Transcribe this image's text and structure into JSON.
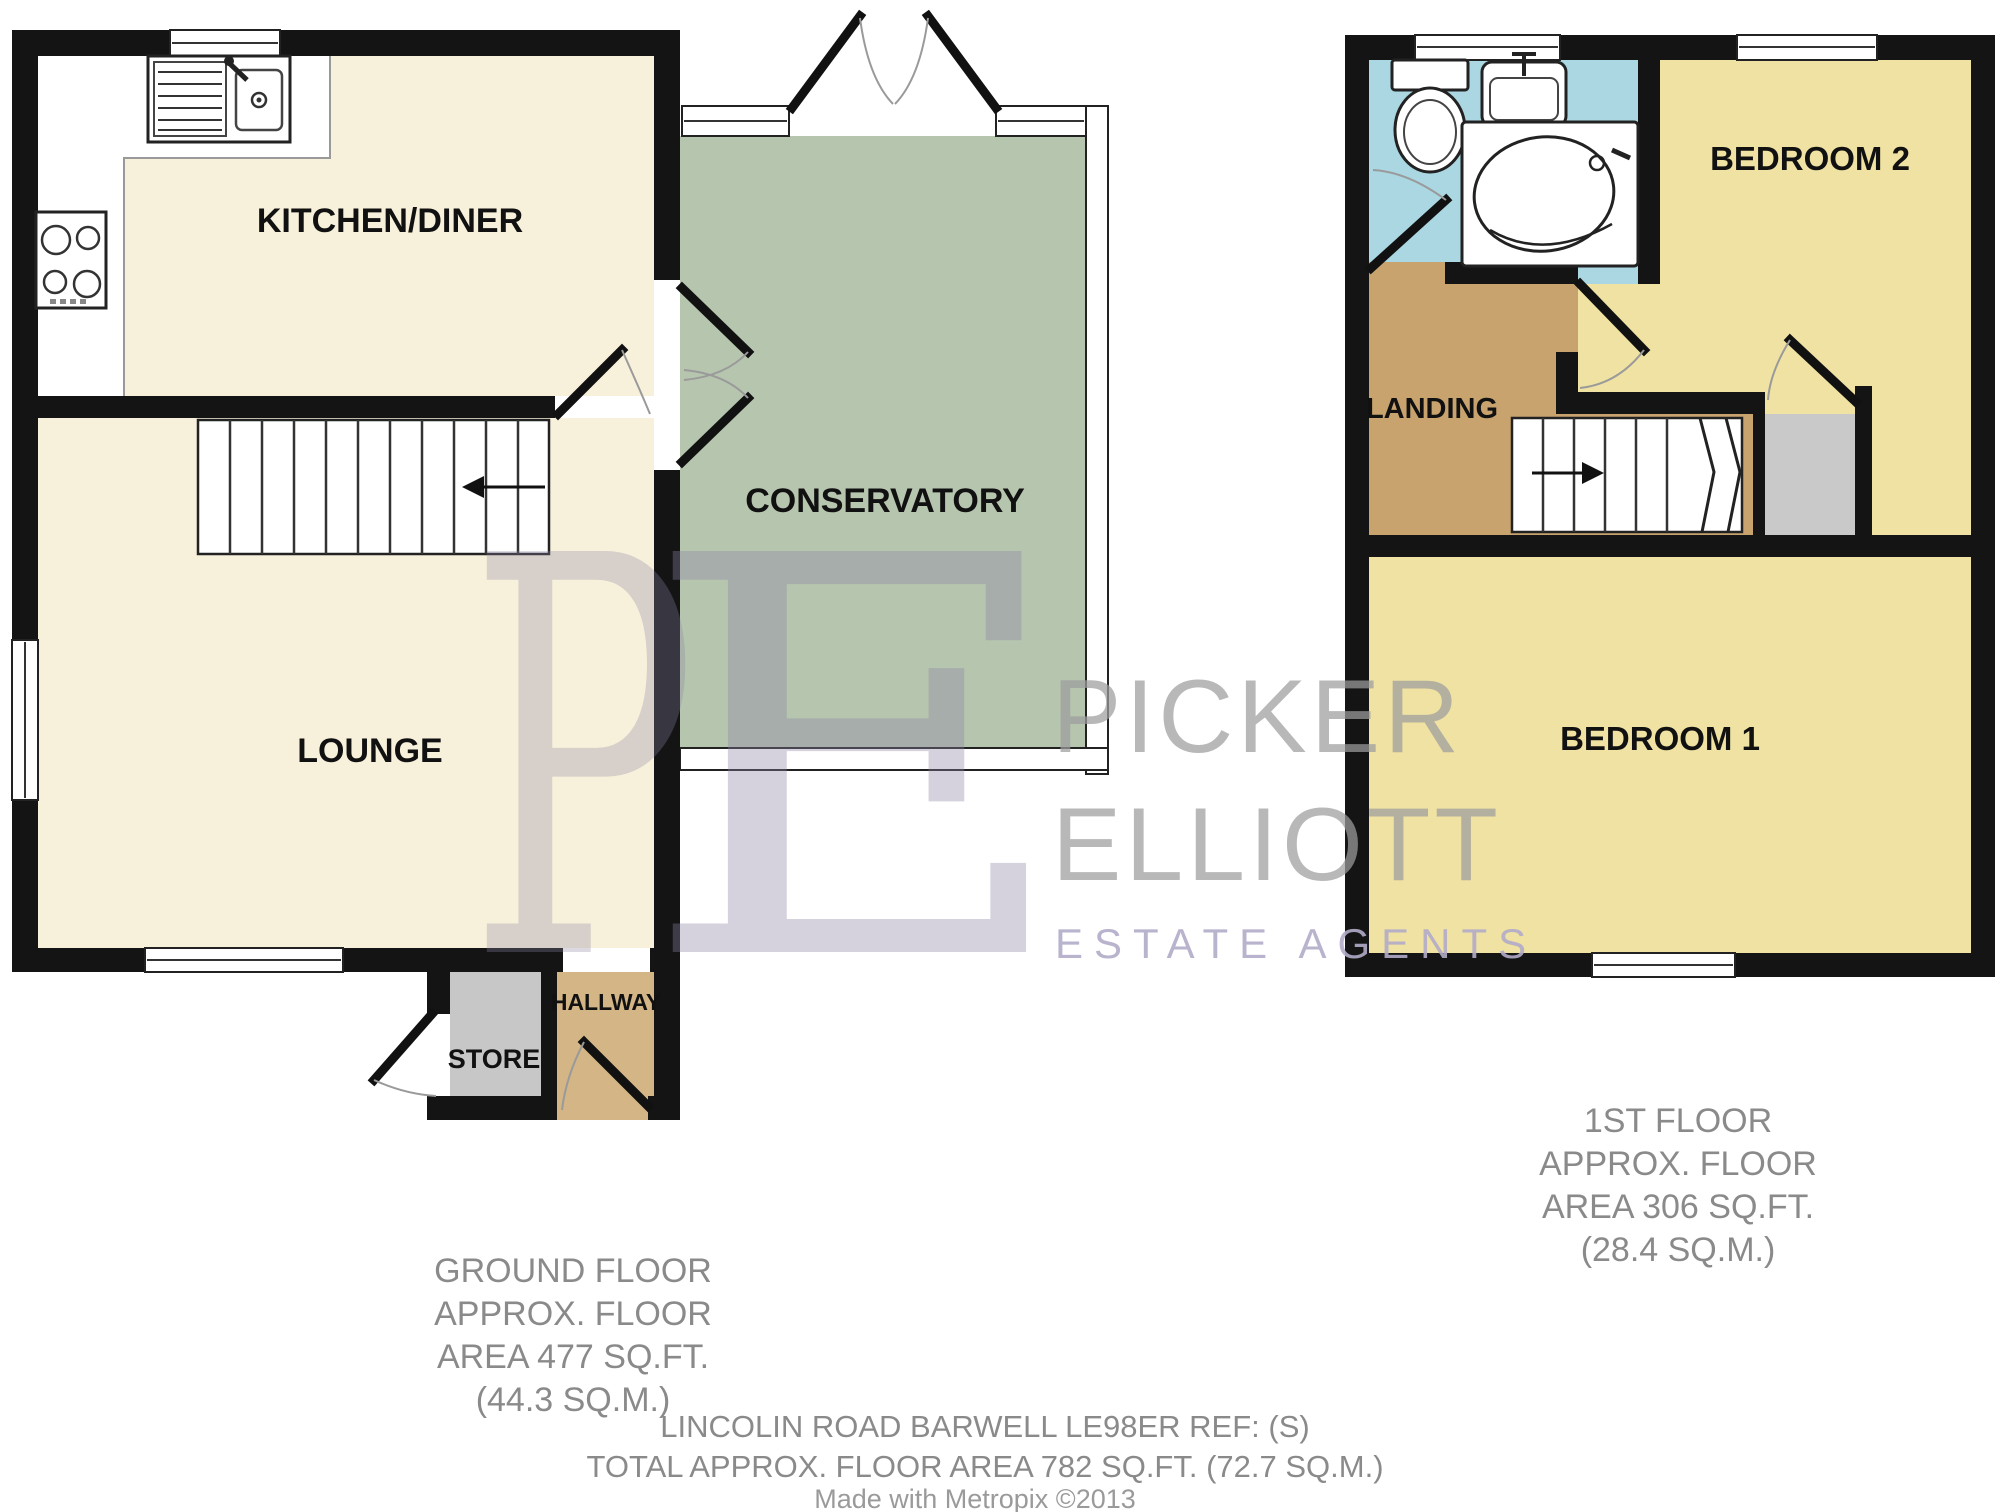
{
  "ground_floor": {
    "rooms": {
      "kitchen_diner": "KITCHEN/DINER",
      "lounge": "LOUNGE",
      "conservatory": "CONSERVATORY",
      "store": "STORE",
      "hallway": "HALLWAY"
    },
    "caption": [
      "GROUND FLOOR",
      "APPROX. FLOOR",
      "AREA 477 SQ.FT.",
      "(44.3 SQ.M.)"
    ]
  },
  "first_floor": {
    "rooms": {
      "landing": "LANDING",
      "bedroom2": "BEDROOM 2",
      "bedroom1": "BEDROOM 1"
    },
    "caption": [
      "1ST FLOOR",
      "APPROX. FLOOR",
      "AREA 306 SQ.FT.",
      "(28.4 SQ.M.)"
    ]
  },
  "footer": {
    "address": "LINCOLIN ROAD BARWELL LE98ER REF: (S)",
    "total": "TOTAL APPROX. FLOOR AREA 782 SQ.FT. (72.7 SQ.M.)",
    "credit": "Made with Metropix ©2013"
  },
  "watermark": {
    "monogram_p": "P",
    "monogram_e": "E",
    "name_top": "PICKER",
    "name_bottom": "ELLIOTT",
    "tagline": "ESTATE AGENTS"
  },
  "colors": {
    "floor_cream": "#f7f0da",
    "conservatory_sage": "#b6c5ae",
    "bedroom_yellow": "#efe2a2",
    "landing_tan": "#c8a36e",
    "hallway_tan": "#d4b586",
    "store_gray": "#c7c7c7",
    "bathroom_blue": "#aad7e2",
    "wall_black": "#141414",
    "watermark_purple": "#8d84a6"
  }
}
